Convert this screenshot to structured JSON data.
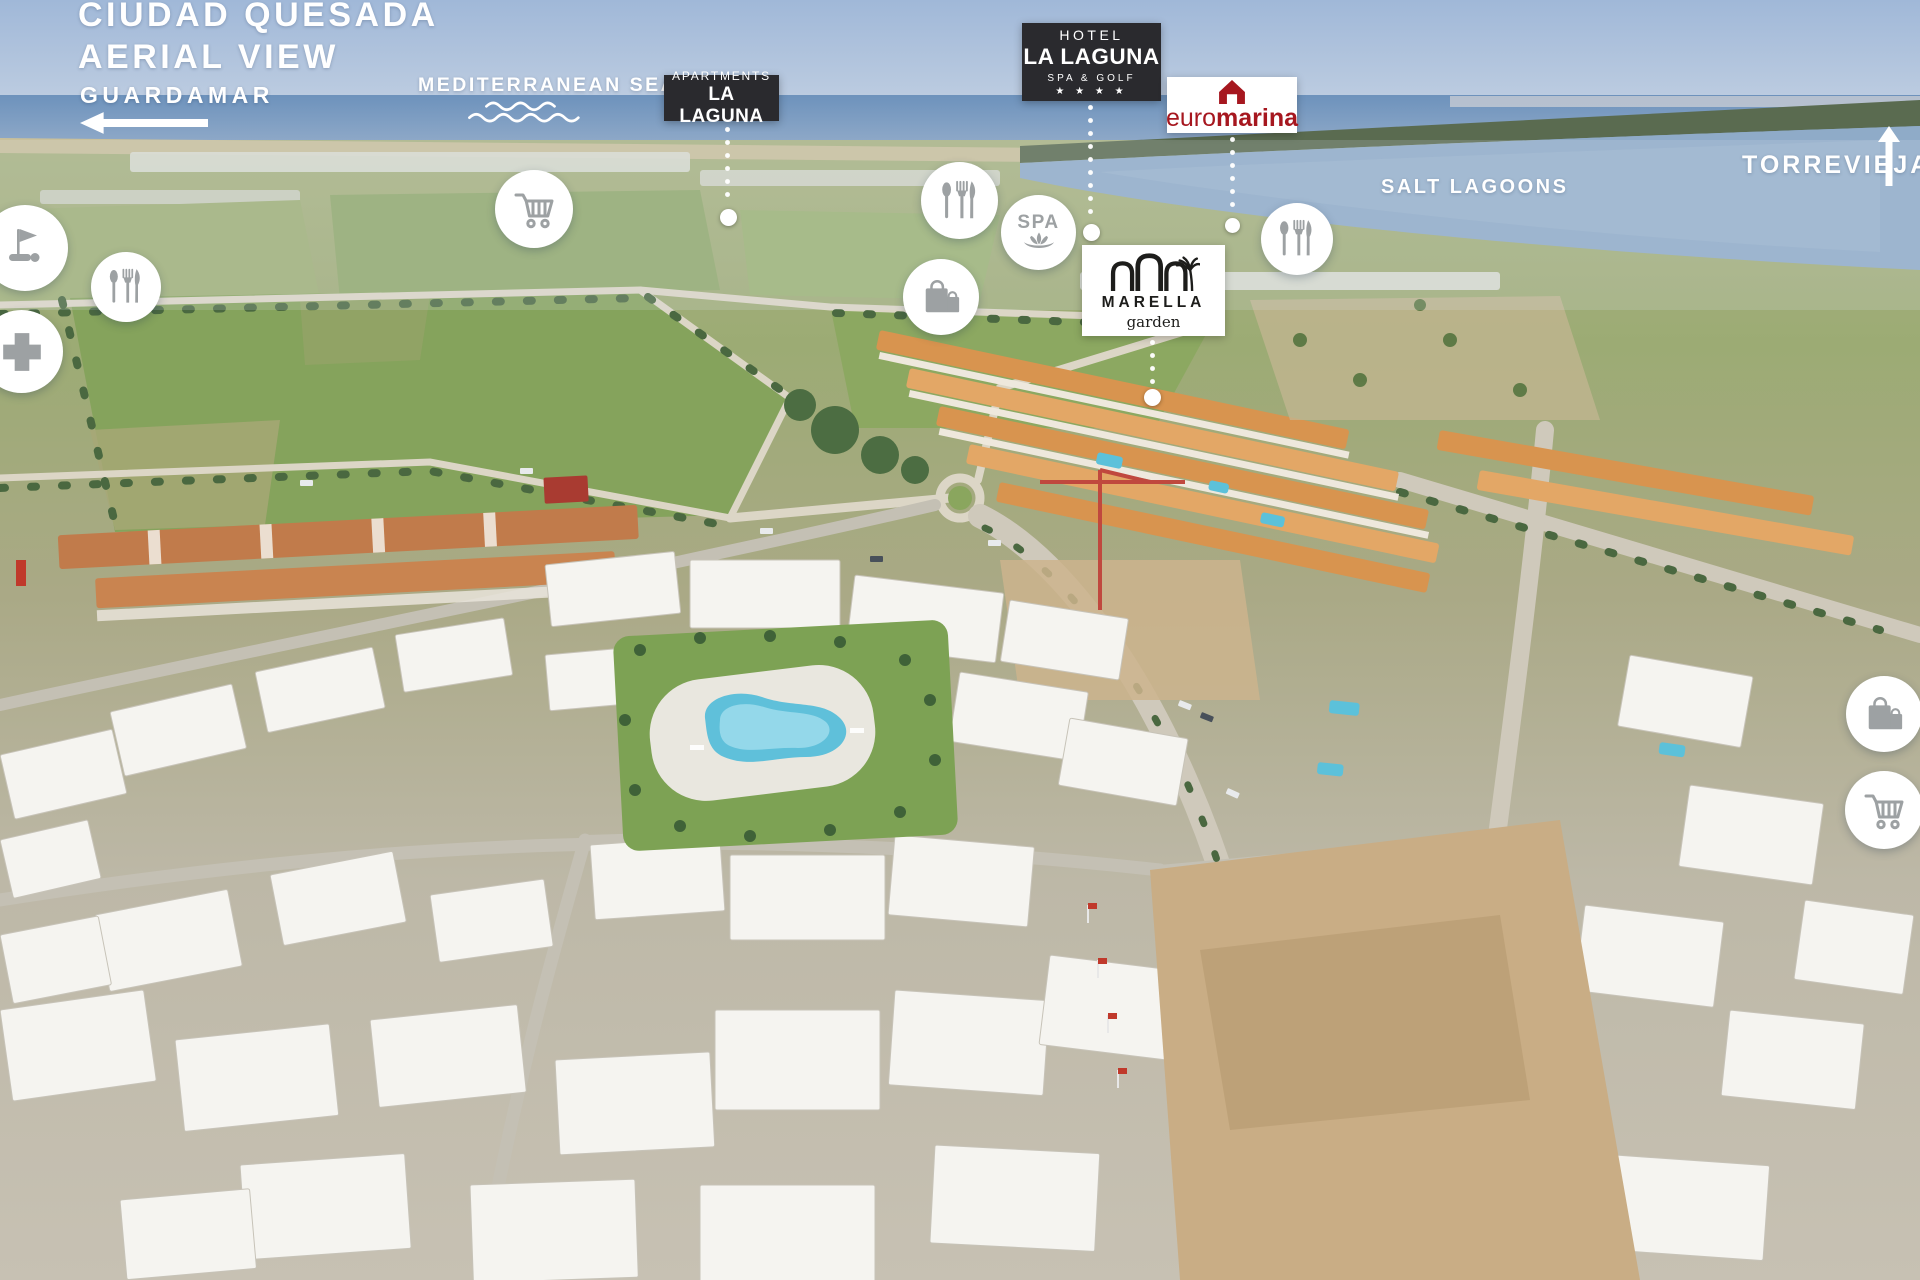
{
  "header": {
    "title_line1": "CIUDAD QUESADA",
    "title_line2": "AERIAL VIEW"
  },
  "directions": {
    "guardamar": {
      "label": "GUARDAMAR",
      "icon": "left-arrow-icon"
    },
    "torrevieja": {
      "label": "TORREVIEJA",
      "icon": "up-arrow-icon"
    }
  },
  "sea_labels": {
    "mediterranean": {
      "label": "MEDITERRANEAN SEA",
      "icon": "waves-icon"
    },
    "salt_lagoons": {
      "label": "SALT LAGOONS"
    }
  },
  "badges": {
    "apartments_la_laguna": {
      "line1": "APARTMENTS",
      "line2": "LA LAGUNA"
    },
    "hotel_la_laguna": {
      "line1": "HOTEL",
      "line2": "LA LAGUNA",
      "line3": "SPA & GOLF",
      "stars": "★ ★ ★ ★"
    },
    "euromarina": {
      "word_light": "euro",
      "word_bold": "marina",
      "icon": "house-icon"
    },
    "marella_garden": {
      "line1": "MARELLA",
      "line2": "garden",
      "icon": "arches-palm-icon"
    }
  },
  "poi": {
    "spa_label": "SPA",
    "marker_icons": [
      "golf-flag-icon",
      "restaurant-icon",
      "medical-cross-icon",
      "shopping-cart-icon",
      "restaurant-icon",
      "spa-lotus-icon",
      "shopping-bag-icon",
      "restaurant-icon",
      "shopping-bag-icon",
      "shopping-cart-icon"
    ]
  },
  "colors": {
    "badge_dark_bg": "#2a2a2e",
    "euromarina_red": "#a6171f",
    "marella_black": "#1d1d1b",
    "icon_gray": "#9da1a3",
    "overlay_white": "#ffffff"
  }
}
